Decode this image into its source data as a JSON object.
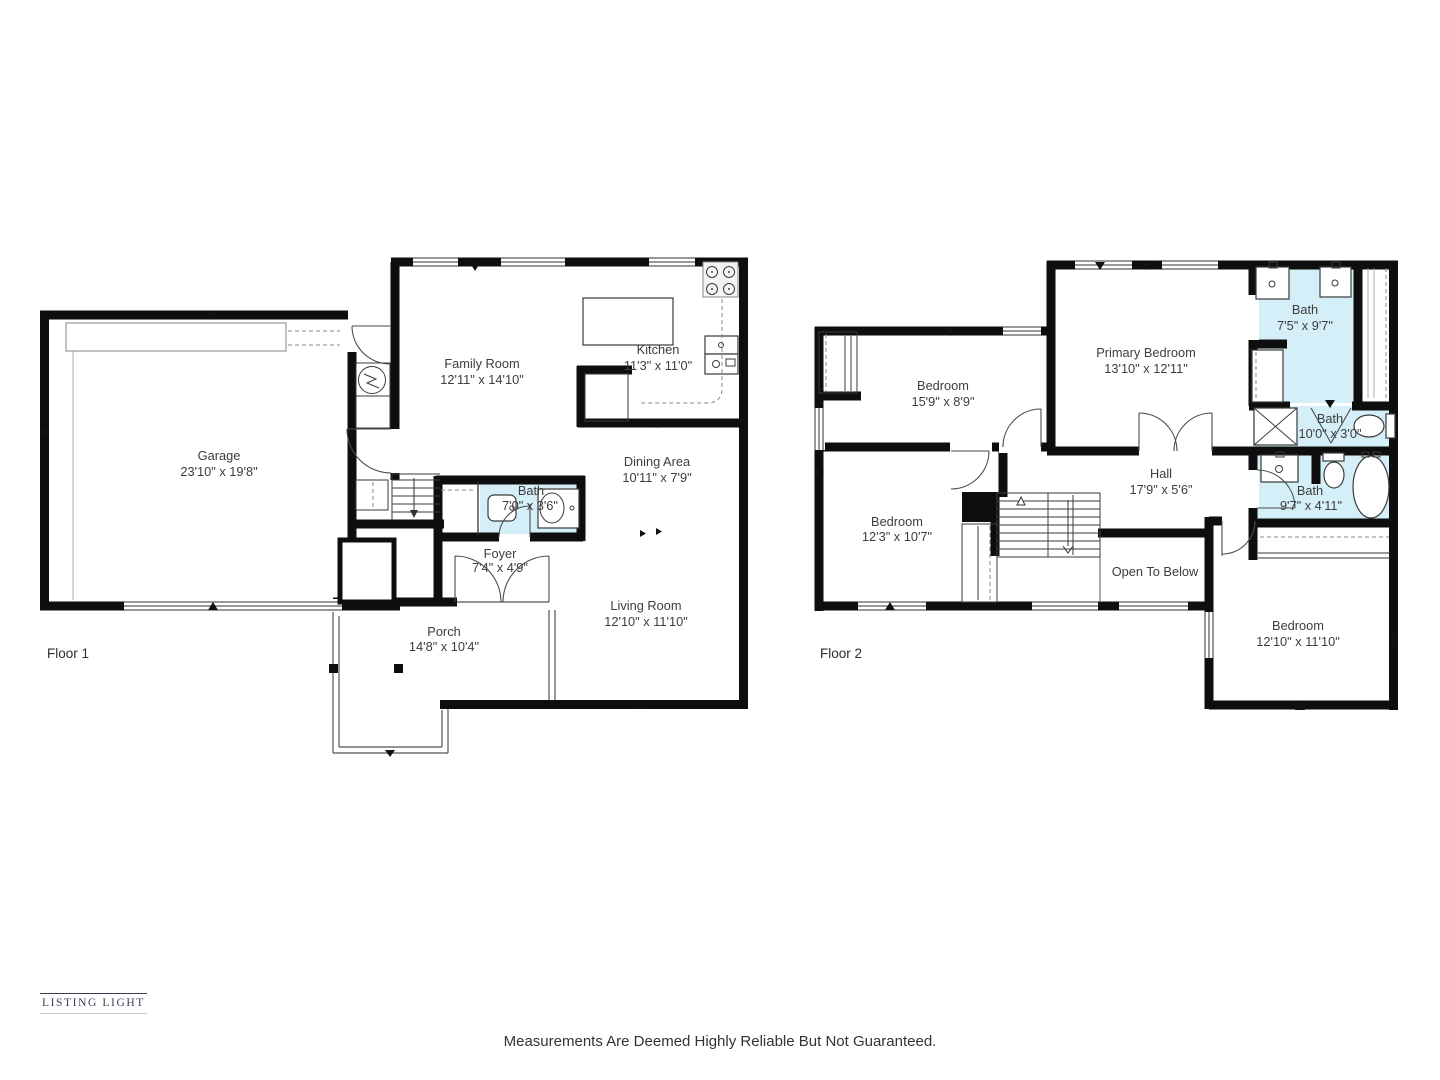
{
  "colors": {
    "bath_fill": "#d4eff7",
    "wall": "#0e0e0e",
    "brand_text": "#3e3c55"
  },
  "icons": [
    "stove-icon",
    "kitchen-sink-icon",
    "kitchen-island",
    "water-heater-icon",
    "toilet-icon",
    "vanity-sink-icon",
    "bathtub-icon",
    "shower-icon",
    "stairs-down-icon",
    "stairs-up-down-icon",
    "wardrobe-icon",
    "closet-icon",
    "door-arc-icon",
    "window-icon"
  ],
  "floor1": {
    "label": "Floor 1",
    "rooms": {
      "garage": {
        "name": "Garage",
        "dims": "23'10\" x 19'8\""
      },
      "family_room": {
        "name": "Family Room",
        "dims": "12'11\" x 14'10\""
      },
      "kitchen": {
        "name": "Kitchen",
        "dims": "11'3\" x 11'0\""
      },
      "dining_area": {
        "name": "Dining Area",
        "dims": "10'11\" x 7'9\""
      },
      "bath": {
        "name": "Bath",
        "dims": "7'0\" x 3'6\""
      },
      "foyer": {
        "name": "Foyer",
        "dims": "7'4\" x 4'9\""
      },
      "living_room": {
        "name": "Living Room",
        "dims": "12'10\" x 11'10\""
      },
      "porch": {
        "name": "Porch",
        "dims": "14'8\" x 10'4\""
      }
    }
  },
  "floor2": {
    "label": "Floor 2",
    "rooms": {
      "bedroom_1": {
        "name": "Bedroom",
        "dims": "15'9\" x 8'9\""
      },
      "primary_bedroom": {
        "name": "Primary Bedroom",
        "dims": "13'10\" x 12'11\""
      },
      "bath_primary": {
        "name": "Bath",
        "dims": "7'5\" x 9'7\""
      },
      "bath_small": {
        "name": "Bath",
        "dims": "10'0\" x 3'0\""
      },
      "bath_hall": {
        "name": "Bath",
        "dims": "9'7\" x 4'11\""
      },
      "hall": {
        "name": "Hall",
        "dims": "17'9\" x 5'6\""
      },
      "bedroom_2": {
        "name": "Bedroom",
        "dims": "12'3\" x 10'7\""
      },
      "open_to_below": {
        "name": "Open To Below"
      },
      "bedroom_3": {
        "name": "Bedroom",
        "dims": "12'10\" x 11'10\""
      }
    }
  },
  "footer": {
    "brand": "LISTING LIGHT",
    "disclaimer": "Measurements Are Deemed Highly Reliable But Not Guaranteed."
  }
}
